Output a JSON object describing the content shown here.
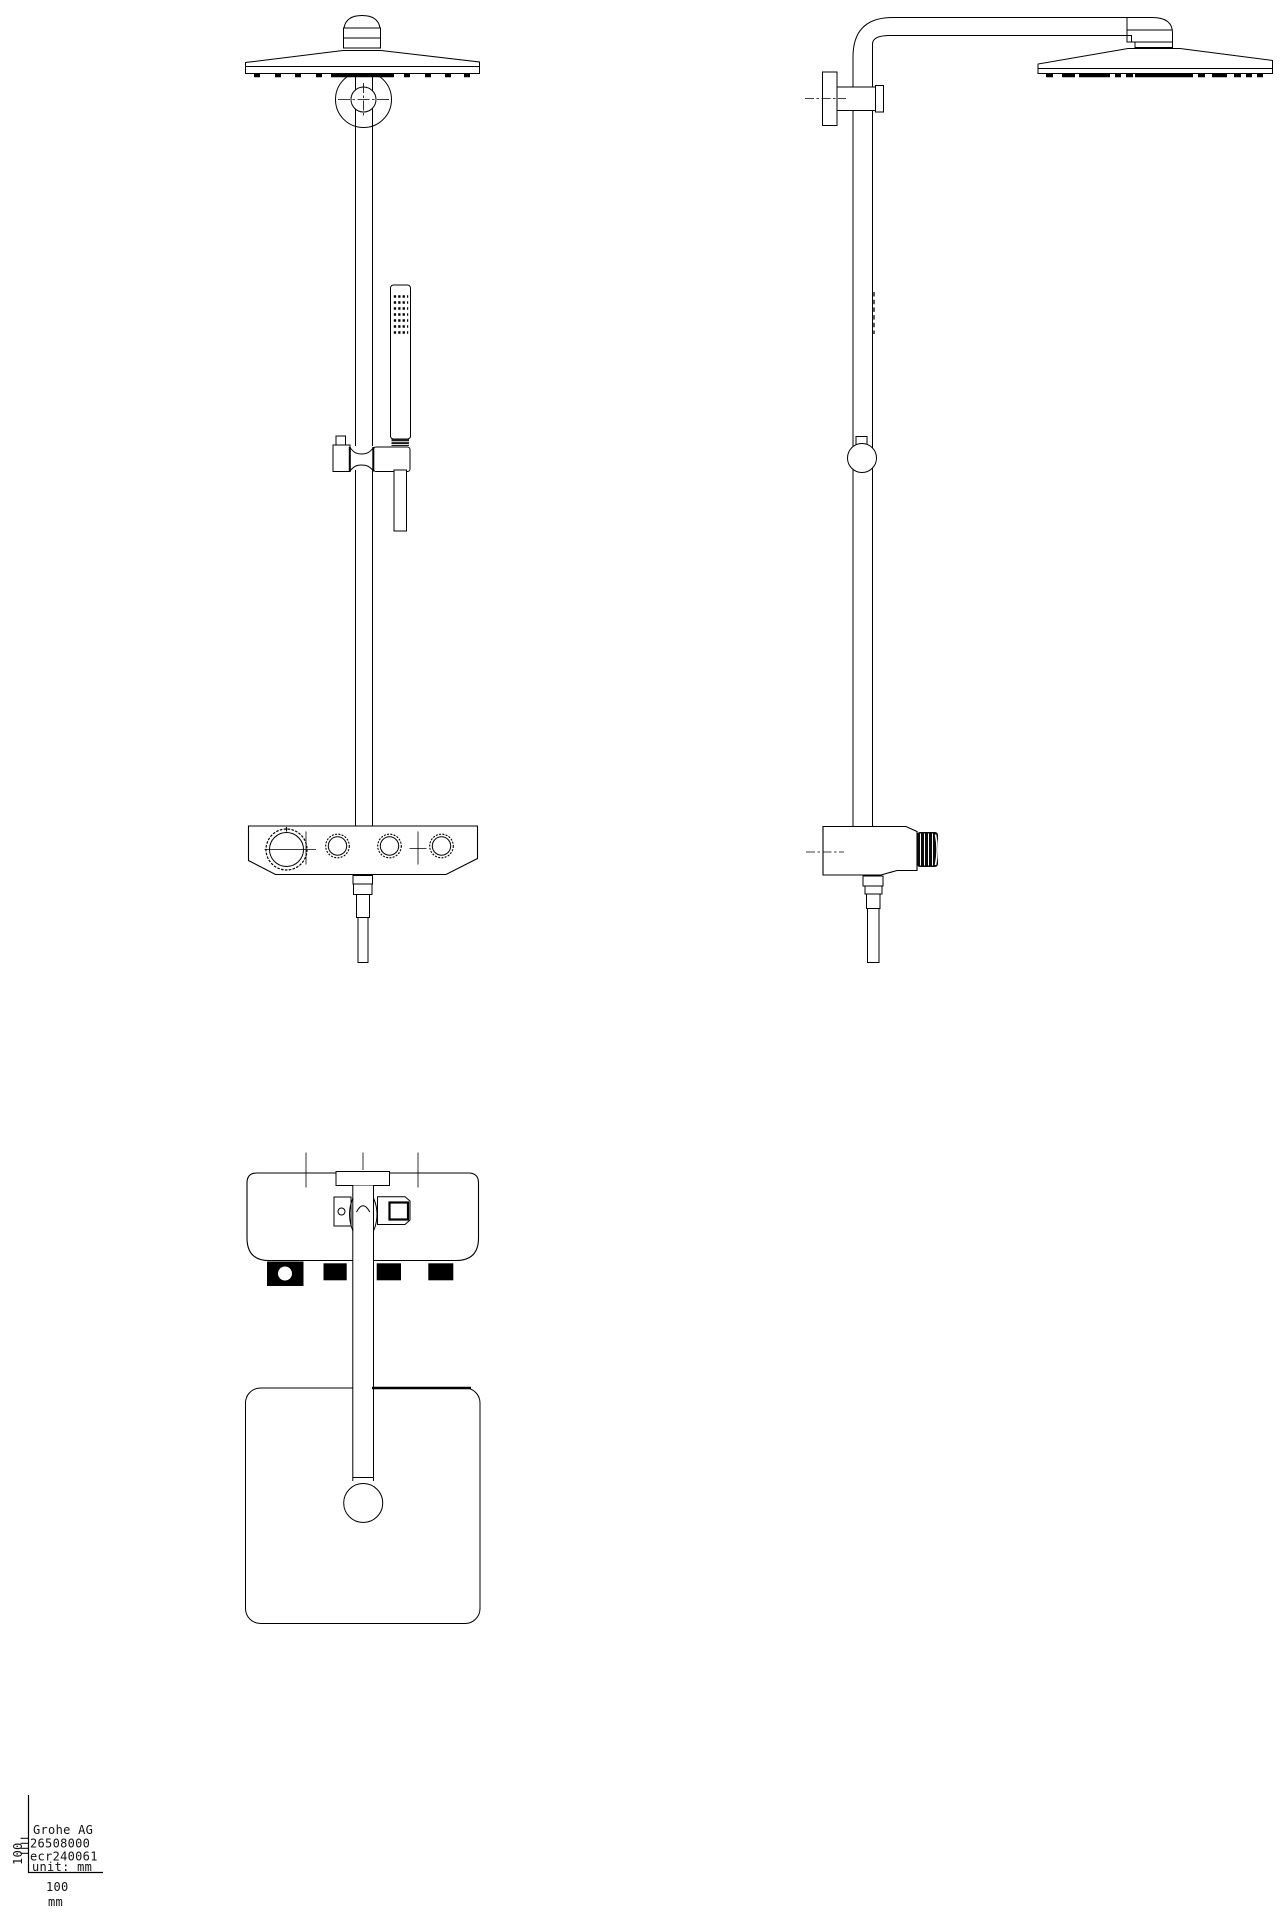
{
  "colors": {
    "background": "#ffffff",
    "line": "#000000"
  },
  "title_block": {
    "company": "Grohe AG",
    "product_number": "26508000",
    "revision": "ecr240061",
    "unit_label": "unit: mm",
    "scale_h_value": "100",
    "scale_h_unit": "mm",
    "scale_v_value": "100"
  }
}
